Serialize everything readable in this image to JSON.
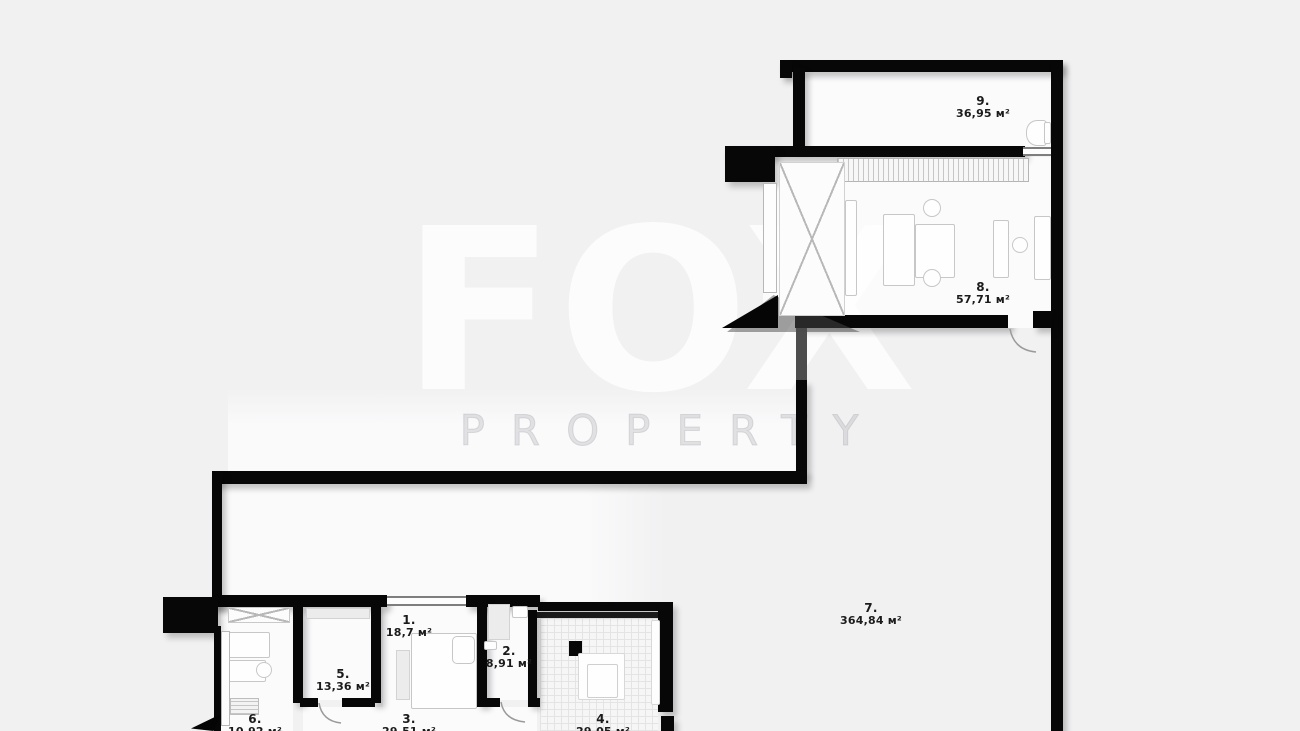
{
  "watermark": {
    "brand": "FOX",
    "tagline": "PROPERTY"
  },
  "unit_symbol": "м²",
  "rooms": [
    {
      "id": "room-9",
      "number": "9.",
      "area": "36,95 м²"
    },
    {
      "id": "room-8",
      "number": "8.",
      "area": "57,71 м²"
    },
    {
      "id": "room-7",
      "number": "7.",
      "area": "364,84 м²"
    },
    {
      "id": "room-1",
      "number": "1.",
      "area": "18,7 м²"
    },
    {
      "id": "room-2",
      "number": "2.",
      "area": "8,91 м²"
    },
    {
      "id": "room-5",
      "number": "5.",
      "area": "13,36 м²"
    },
    {
      "id": "room-6",
      "number": "6.",
      "area": "10,92 м²"
    },
    {
      "id": "room-3",
      "number": "3.",
      "area": "29,51 м²"
    },
    {
      "id": "room-4",
      "number": "4.",
      "area": "29,05 м²"
    }
  ],
  "colors": {
    "background": "#f1f1f2",
    "wall": "#070707",
    "floor": "#fbfbfc",
    "label_text": "#1b1b1b",
    "watermark": "#ffffff",
    "shadow": "rgba(0,0,0,0.22)"
  }
}
